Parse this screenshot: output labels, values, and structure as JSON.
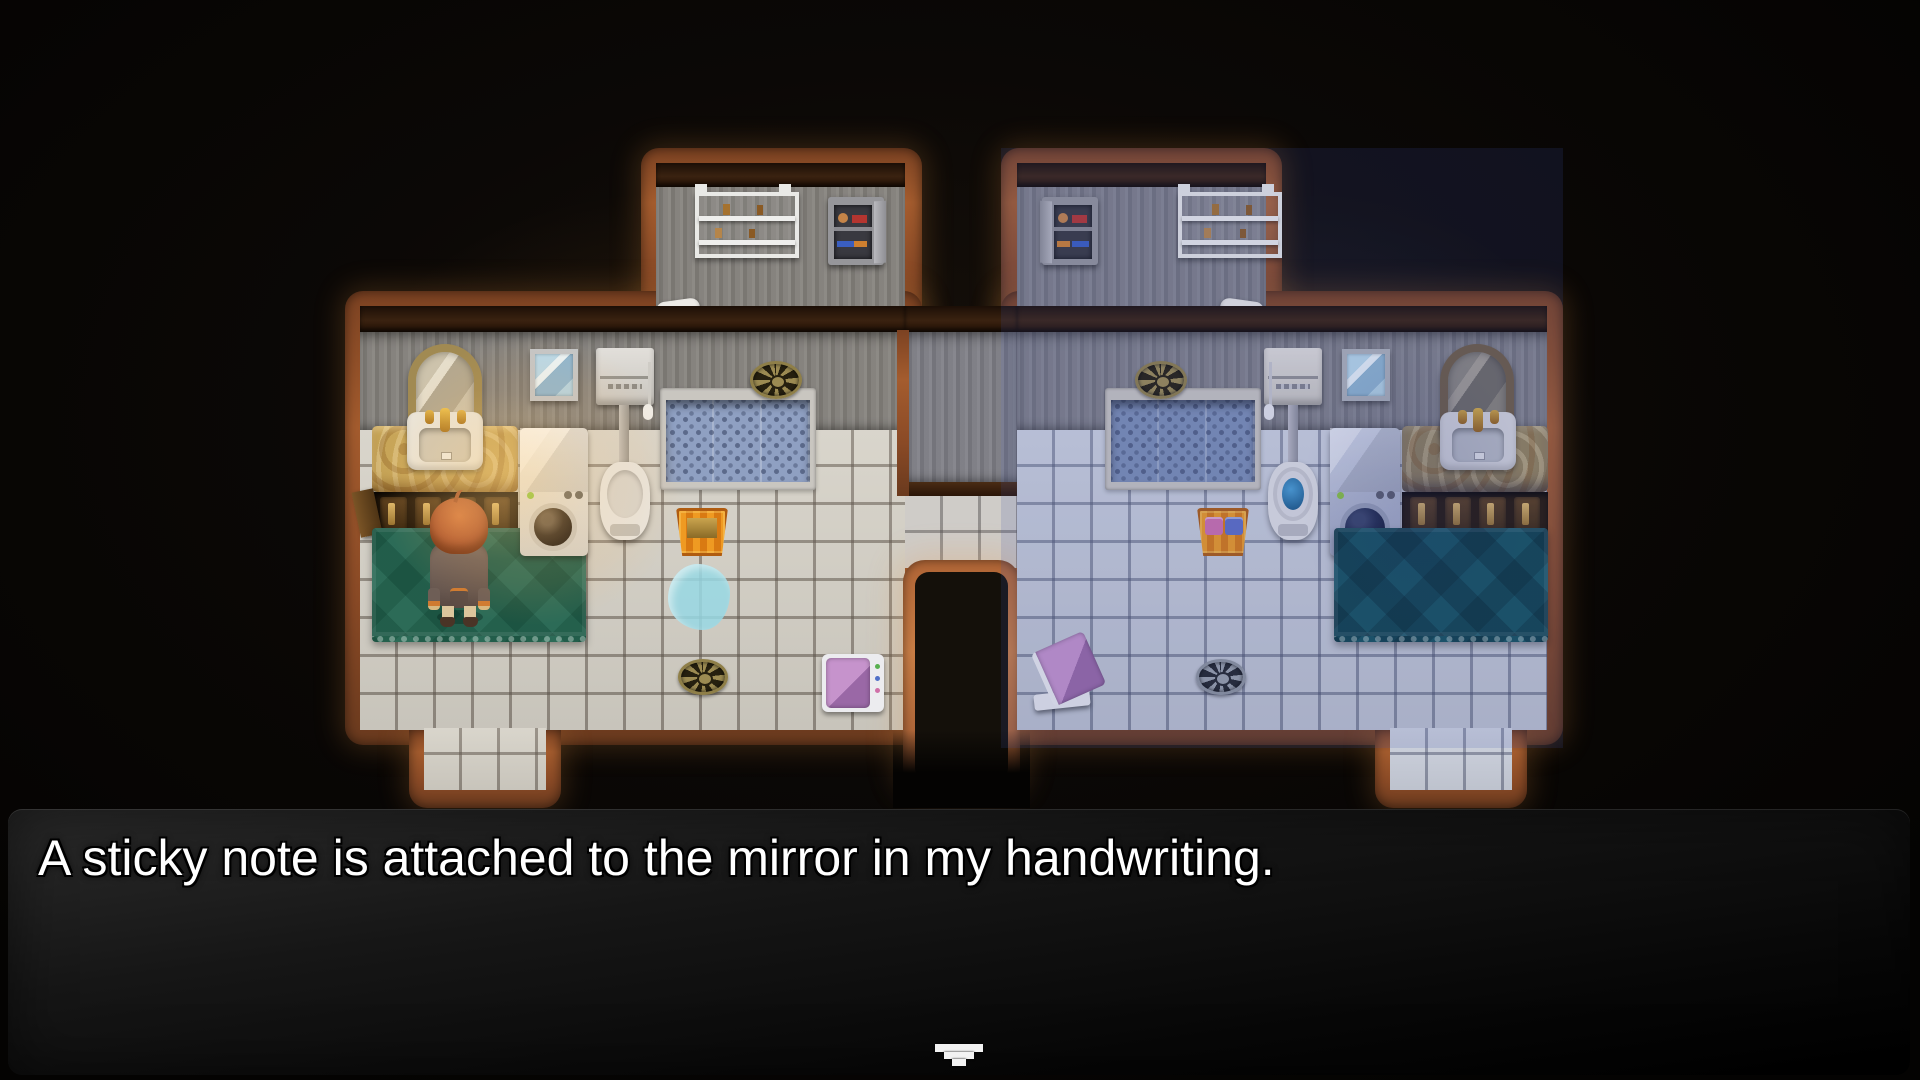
{
  "dialogue": {
    "text": "A sticky note is attached to the mirror in my handwriting.",
    "continue_indicator": "pixel-down-arrow"
  },
  "scene": {
    "style": "top-down pixel-art interior: two mirrored bathrooms joined by a lower passage",
    "left_bathroom": {
      "lighting": "warm yellow",
      "fixtures": [
        "wall shelf",
        "medicine cabinet",
        "arched mirror",
        "sink on marble counter",
        "cabinet doors (one open)",
        "small wall mirror",
        "toilet with wall tank",
        "washing machine",
        "sunken bath",
        "floor drain (top)",
        "empty laundry basket",
        "water puddle",
        "floor drain (bottom)",
        "bathroom scale",
        "green bath rug"
      ],
      "character_present": true
    },
    "right_bathroom": {
      "lighting": "cool blue",
      "fixtures": [
        "medicine cabinet",
        "wall shelf",
        "arched mirror",
        "sink on marble counter",
        "cabinet doors",
        "small wall mirror",
        "toilet with open lid",
        "washing machine",
        "sunken bath",
        "floor drain (top)",
        "laundry basket with clothes",
        "floor drain (bottom)",
        "tilted bathroom scale",
        "teal bath rug"
      ],
      "character_present": false
    },
    "character": {
      "hair_color": "orange",
      "outfit": "brown coat with orange cuffs, tan pants, dark boots",
      "facing": "up"
    }
  },
  "colors": {
    "wood_border": "#9a5528",
    "warm_light": "#ffc878",
    "cool_light": "#5a6fc0",
    "left_rug": "#2c6b57",
    "right_rug": "#15525e",
    "basket": "#e08a1c",
    "scale_top": "#a06fae",
    "dialogue_bg": "#141414",
    "dialogue_text": "#ffffff"
  }
}
